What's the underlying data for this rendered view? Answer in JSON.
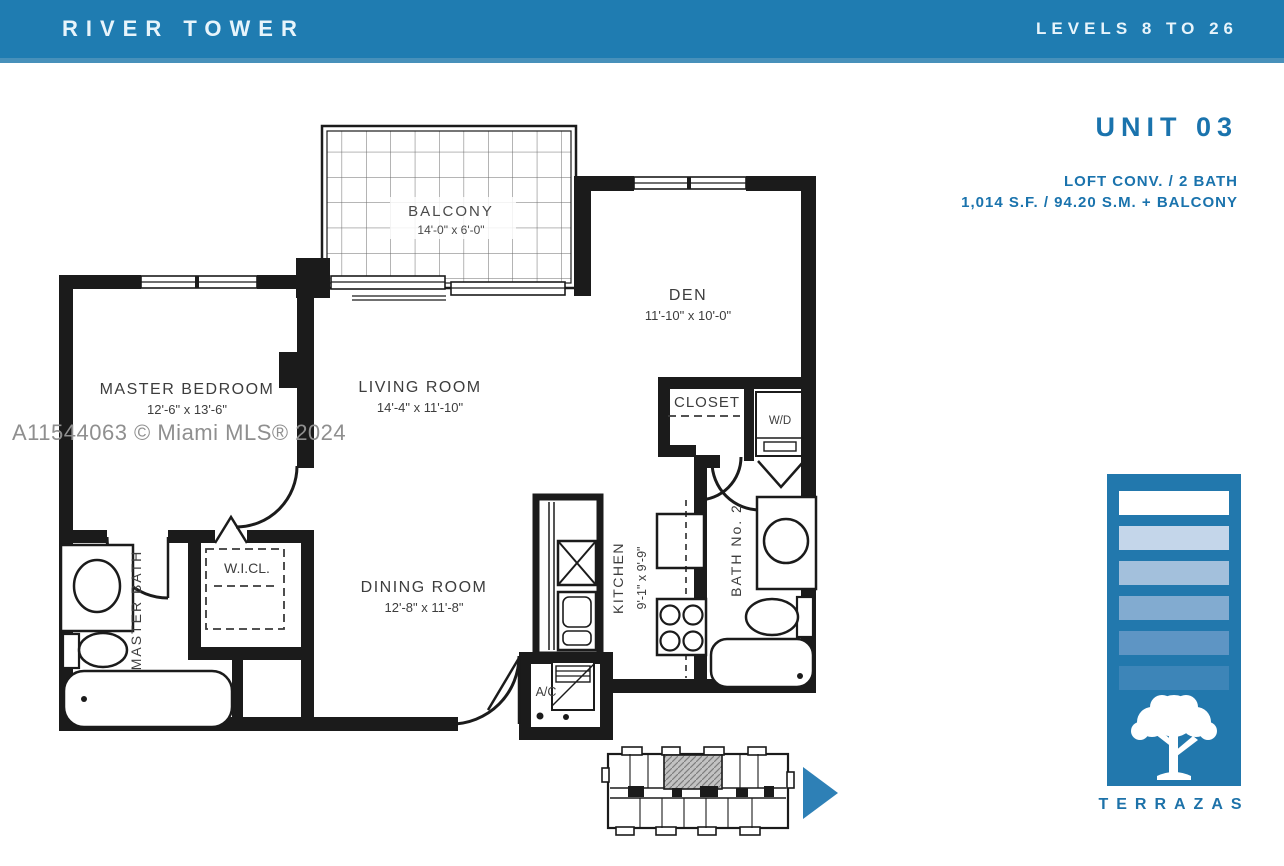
{
  "header": {
    "title": "RIVER TOWER",
    "levels": "LEVELS 8 TO 26"
  },
  "unit": {
    "name": "UNIT 03",
    "config": "LOFT CONV. / 2 BATH",
    "area": "1,014 S.F. / 94.20 S.M. + BALCONY"
  },
  "watermark": "A11544063 © Miami MLS® 2024",
  "rooms": {
    "balcony": {
      "label": "BALCONY",
      "dims": "14'-0\" x 6'-0\""
    },
    "den": {
      "label": "DEN",
      "dims": "11'-10\" x 10'-0\""
    },
    "master_bedroom": {
      "label": "MASTER  BEDROOM",
      "dims": "12'-6\" x 13'-6\""
    },
    "living_room": {
      "label": "LIVING  ROOM",
      "dims": "14'-4\" x 11'-10\""
    },
    "dining_room": {
      "label": "DINING  ROOM",
      "dims": "12'-8\" x 11'-8\""
    },
    "kitchen": {
      "label": "KITCHEN",
      "dims": "9'-1\" x 9'-9\""
    },
    "bath_2": {
      "label": "BATH  No. 2"
    },
    "master_bath": {
      "label": "MASTER  BATH"
    },
    "walk_in_closet": {
      "label": "W.I.CL."
    },
    "closet": {
      "label": "CLOSET"
    },
    "washer_dryer": {
      "label": "W/D"
    },
    "ac_closet": {
      "label": "A/C"
    }
  },
  "brand": {
    "name": "TERRAZAS"
  },
  "icons": {
    "key_plan_arrow": "right-triangle",
    "logo_tree": "tree-silhouette"
  },
  "colors": {
    "header_bg": "#1f7cb1",
    "header_text": "#e7f4fb",
    "accent_blue": "#1a73ad",
    "logo_bg": "#2278ad",
    "logo_bars": [
      "#ffffff",
      "#c4d6ea",
      "#a3c0dc",
      "#82abd0",
      "#5e95c4",
      "#3d85b8"
    ],
    "arrow_blue": "#2e80b6",
    "plan_line": "#1b1b1b",
    "watermark_gray": "#8f8f8f"
  }
}
